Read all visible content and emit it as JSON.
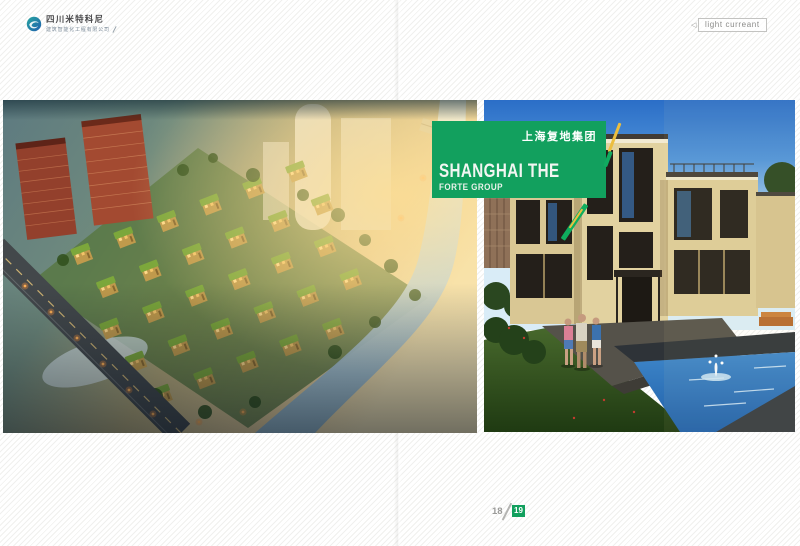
{
  "page": {
    "accent_green": "#12a05e",
    "accent_yellow": "#ecbe3f",
    "background": "#ffffff"
  },
  "header": {
    "logo_brand": "四川米特科尼",
    "logo_subtitle": "建筑智能化工程有限公司",
    "tag_label": "light curreant"
  },
  "banner": {
    "group_cn": "上海复地集团",
    "title": "SHANGHAI THE",
    "subtitle": "FORTE GROUP"
  },
  "footer": {
    "page_left": "18",
    "page_right": "19"
  },
  "photos": {
    "left_description": "Aerial dusk rendering of riverside villa community with green roofs",
    "right_description": "Modern beige villa with pool, fountain and three people"
  }
}
